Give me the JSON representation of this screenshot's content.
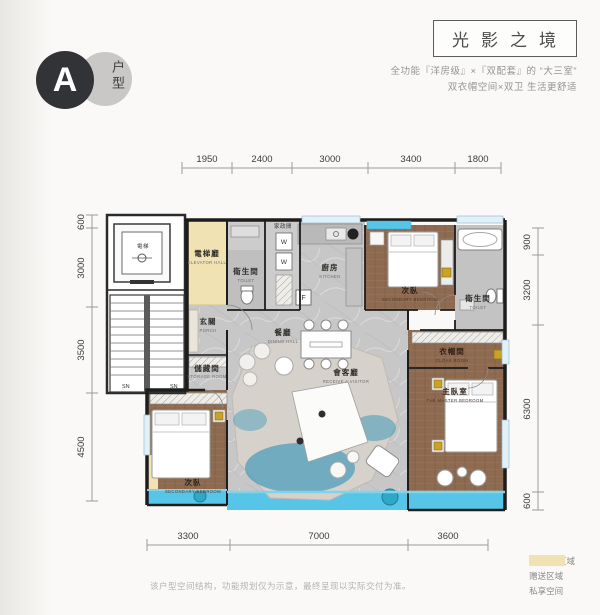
{
  "badge": {
    "letter": "A",
    "label": "户型"
  },
  "header": {
    "title": "光影之境",
    "subtitle1": "全功能『洋房级』×『双配套』的 “大三室”",
    "subtitle2": "双衣帽空间×双卫 生活更舒适"
  },
  "dims": {
    "top": [
      "1950",
      "2400",
      "3000",
      "3400",
      "1800"
    ],
    "left": [
      "600",
      "3000",
      "3500",
      "4500"
    ],
    "right": [
      "900",
      "3200",
      "6300",
      "600"
    ],
    "bottom": [
      "3300",
      "7000",
      "3600"
    ]
  },
  "rooms": {
    "elevator": {
      "zh": "電梯"
    },
    "elevator_hall": {
      "zh": "電梯廳",
      "en": "ELEVATOR HALL"
    },
    "toilet1": {
      "zh": "衛生間",
      "en": "TOILET"
    },
    "laundry": {
      "zh": "家政間"
    },
    "kitchen": {
      "zh": "廚房",
      "en": "KITCHEN"
    },
    "foyer": {
      "zh": "玄關",
      "en": "PORCH"
    },
    "dining": {
      "zh": "餐廳",
      "en": "DINING HALL"
    },
    "living": {
      "zh": "會客廳",
      "en": "RECEIVE A VISITOR"
    },
    "bedroom2": {
      "zh": "次臥",
      "en": "SECONDARY BEDROOM"
    },
    "toilet2": {
      "zh": "衛生間",
      "en": "TOILET"
    },
    "cloak": {
      "zh": "衣帽間",
      "en": "CLOAK ROOM"
    },
    "master": {
      "zh": "主臥室",
      "en": "THE MASTER BEDROOM"
    },
    "storage": {
      "zh": "儲藏間",
      "en": "STORAGE ROOM"
    },
    "bedroom3": {
      "zh": "次臥",
      "en": "SECONDARY BEDROOM"
    },
    "stair_mark": "SN",
    "washer": "W",
    "stove": "F"
  },
  "legend": {
    "items": [
      {
        "label": "1/2赠送区域",
        "color": "#57c5e8"
      },
      {
        "label": "赠送区域",
        "color": "#4e9dbb"
      },
      {
        "label": "私享空间",
        "color": "#f0e2b2"
      }
    ]
  },
  "footer": {
    "disclaimer": "该户型空间结构，功能规划仅为示意，最终呈现以实际交付为准。"
  }
}
